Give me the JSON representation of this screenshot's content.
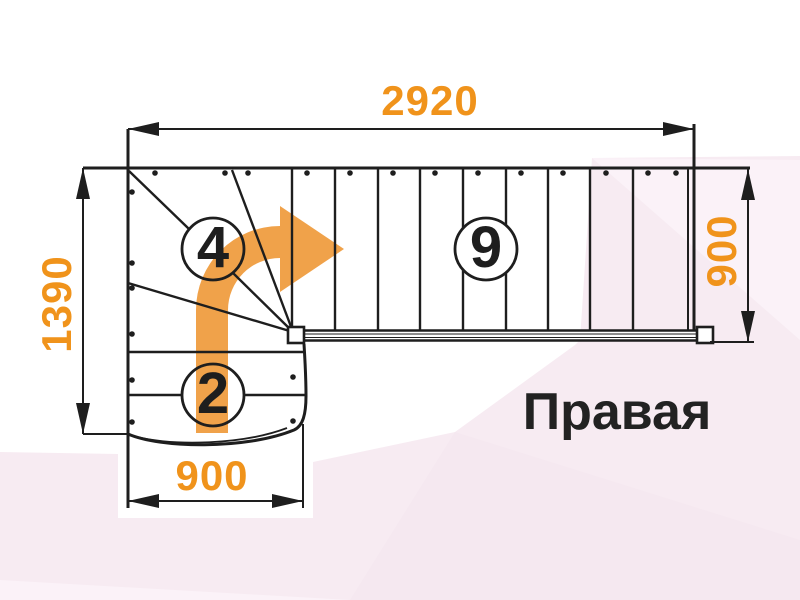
{
  "drawing": {
    "title": "Правая",
    "dimensions": {
      "top": "2920",
      "left": "1390",
      "bottom": "900",
      "right": "900"
    },
    "step_counts": {
      "winder_flight": "4",
      "straight_flight": "9",
      "lower_flight": "2"
    }
  },
  "icons": {
    "turn_arrow": "curved-right-turn-arrow"
  },
  "colors": {
    "dimension_orange": "#f0931b",
    "arrow_orange": "#f0a24a",
    "line_black": "#1e1e1e",
    "title_color": "#222222",
    "background_pink": "#f7ebf2",
    "background_pink_light": "#fbf2f8",
    "background_pink_deep": "#f5e8f0",
    "background_white": "#ffffff"
  }
}
